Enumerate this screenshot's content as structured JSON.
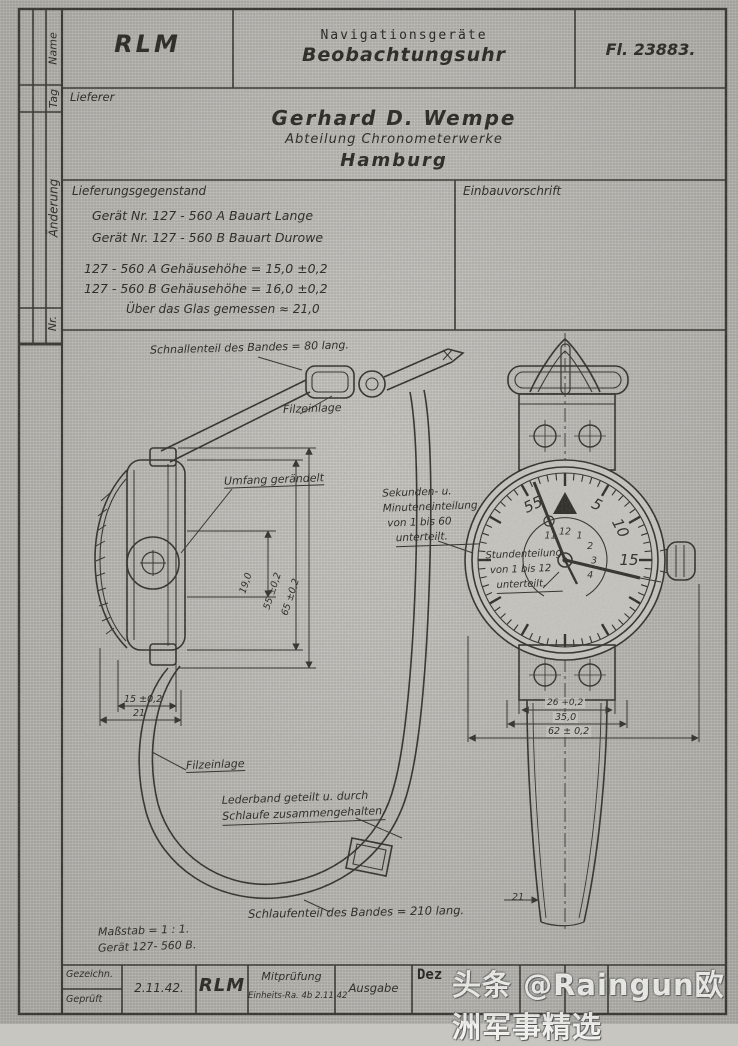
{
  "header": {
    "org": "RLM",
    "category": "Navigationsgeräte",
    "title": "Beobachtungsuhr",
    "doc_number": "Fl. 23883."
  },
  "margin": {
    "name": "Name",
    "tag": "Tag",
    "aenderung": "Änderung",
    "nr": "Nr."
  },
  "supplier": {
    "label": "Lieferer",
    "name": "Gerhard D. Wempe",
    "dept": "Abteilung Chronometerwerke",
    "city": "Hamburg"
  },
  "delivery": {
    "label": "Lieferungsgegenstand",
    "lines": [
      "Gerät Nr.  127 - 560 A    Bauart  Lange",
      "Gerät Nr.  127 - 560 B    Bauart  Durowe",
      "127 - 560 A    Gehäusehöhe  =  15,0 ±0,2",
      "127 - 560 B    Gehäusehöhe  =  16,0 ±0,2",
      "Über das Glas gemessen  ≈  21,0"
    ]
  },
  "install": {
    "label": "Einbauvorschrift"
  },
  "drawing": {
    "labels": {
      "buckle_strap": "Schnallenteil des Bandes = 80 lang.",
      "felt_top": "Filzeinlage",
      "knurl": "Umfang gerändelt",
      "seconds": [
        "Sekunden- u.",
        "Minuteneinteilung",
        "von 1 bis 60",
        "unterteilt."
      ],
      "hours": [
        "Stundenteilung",
        "von 1 bis 12",
        "unterteilt."
      ],
      "felt_bottom": "Filzeinlage",
      "leather": [
        "Lederband geteilt u. durch",
        "Schlaufe zusammengehalten."
      ],
      "loop_strap": "Schlaufenteil des Bandes = 210 lang.",
      "scale": "Maßstab = 1 : 1.",
      "device": "Gerät 127- 560 B."
    },
    "dims": {
      "inner_height": "19,0",
      "case_dia": "55 ±0,2",
      "overall": "65 ±0,2",
      "case_height": "15 ±0,2",
      "glass_height": "21",
      "strap_width": "26 +0,2",
      "lug_width": "35,0",
      "case_width": "62 ± 0,2",
      "strap_end": "21"
    },
    "dial": {
      "outer_numbers": [
        "55",
        "5",
        "10",
        "15"
      ],
      "inner_numbers": [
        "11",
        "12",
        "1",
        "2",
        "3",
        "4"
      ]
    }
  },
  "titleblock": {
    "drawn": "Gezeichn.",
    "checked": "Geprüft",
    "date": "2.11.42.",
    "org": "RLM",
    "cocheck1": "Mitprüfung",
    "cocheck2": "Einheits-Ra. 4b 2.11.42",
    "issue": "Ausgabe",
    "dept": "Dez"
  },
  "watermark": "头条 @Raingun欧洲军事精选"
}
